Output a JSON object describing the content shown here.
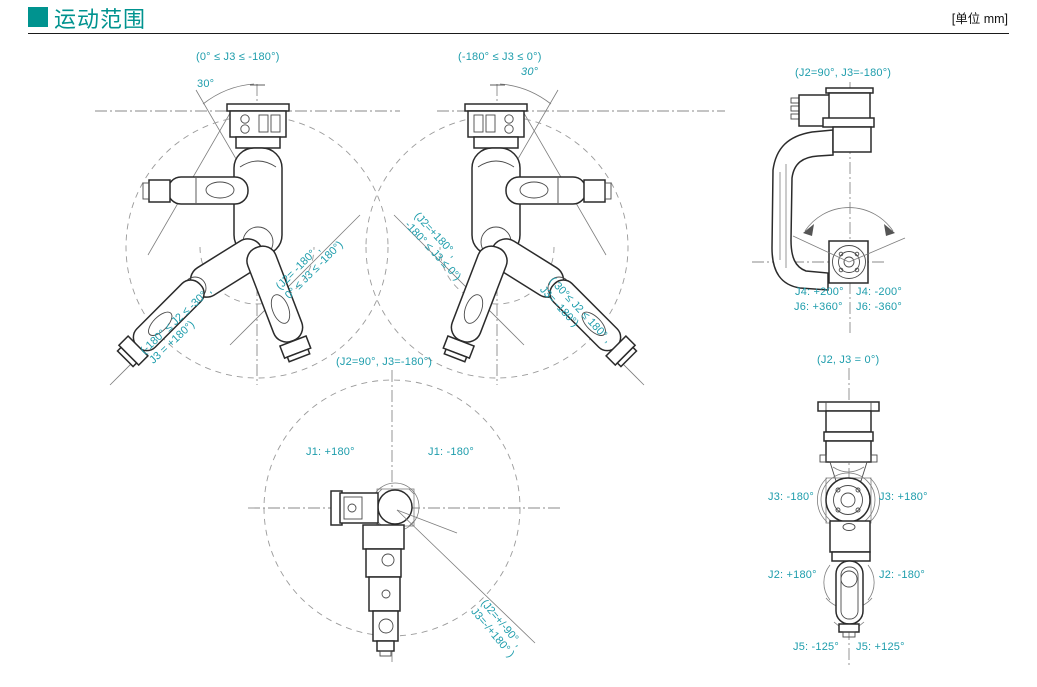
{
  "page": {
    "title": "运动范围",
    "unit_label": "[单位 mm]",
    "accent_color": "#00938F",
    "annotation_color": "#1E9DAC"
  },
  "diagrams": {
    "top_left": {
      "caption": "(0° ≤ J3 ≤ -180°)",
      "angle": "30°",
      "range_label_1": {
        "line1": "(J2= -180° ,",
        "line2": "0° ≤ J3 ≤ -180°)"
      },
      "range_label_2": {
        "line1": "(-180° ≤ J2 ≤ -30° ,",
        "line2": "J3 = +180°)"
      }
    },
    "top_middle": {
      "caption": "(-180° ≤ J3 ≤ 0°)",
      "angle": "30°",
      "range_label_1": {
        "line1": "(J2=+180° ,",
        "line2": "-180° ≤ J3 ≤ 0°)"
      },
      "range_label_2": {
        "line1": "( 30°≤ J2 ≤ 180° ,",
        "line2": "J3= -180°)"
      }
    },
    "top_right": {
      "caption": "(J2=90°, J3=-180°)",
      "j4_plus": "J4: +200°",
      "j4_minus": "J4: -200°",
      "j6_plus": "J6: +360°",
      "j6_minus": "J6: -360°"
    },
    "bottom_middle": {
      "caption": "(J2=90°, J3=-180°)",
      "j1_plus": "J1: +180°",
      "j1_minus": "J1: -180°",
      "range_label": {
        "line1": "(J2=+/-90° ,",
        "line2": "J3=-/+180° )"
      }
    },
    "bottom_right": {
      "caption": "(J2, J3 =  0°)",
      "j3_minus": "J3: -180°",
      "j3_plus": "J3: +180°",
      "j2_plus": "J2: +180°",
      "j2_minus": "J2: -180°",
      "j5_minus": "J5: -125°",
      "j5_plus": "J5: +125°"
    }
  }
}
